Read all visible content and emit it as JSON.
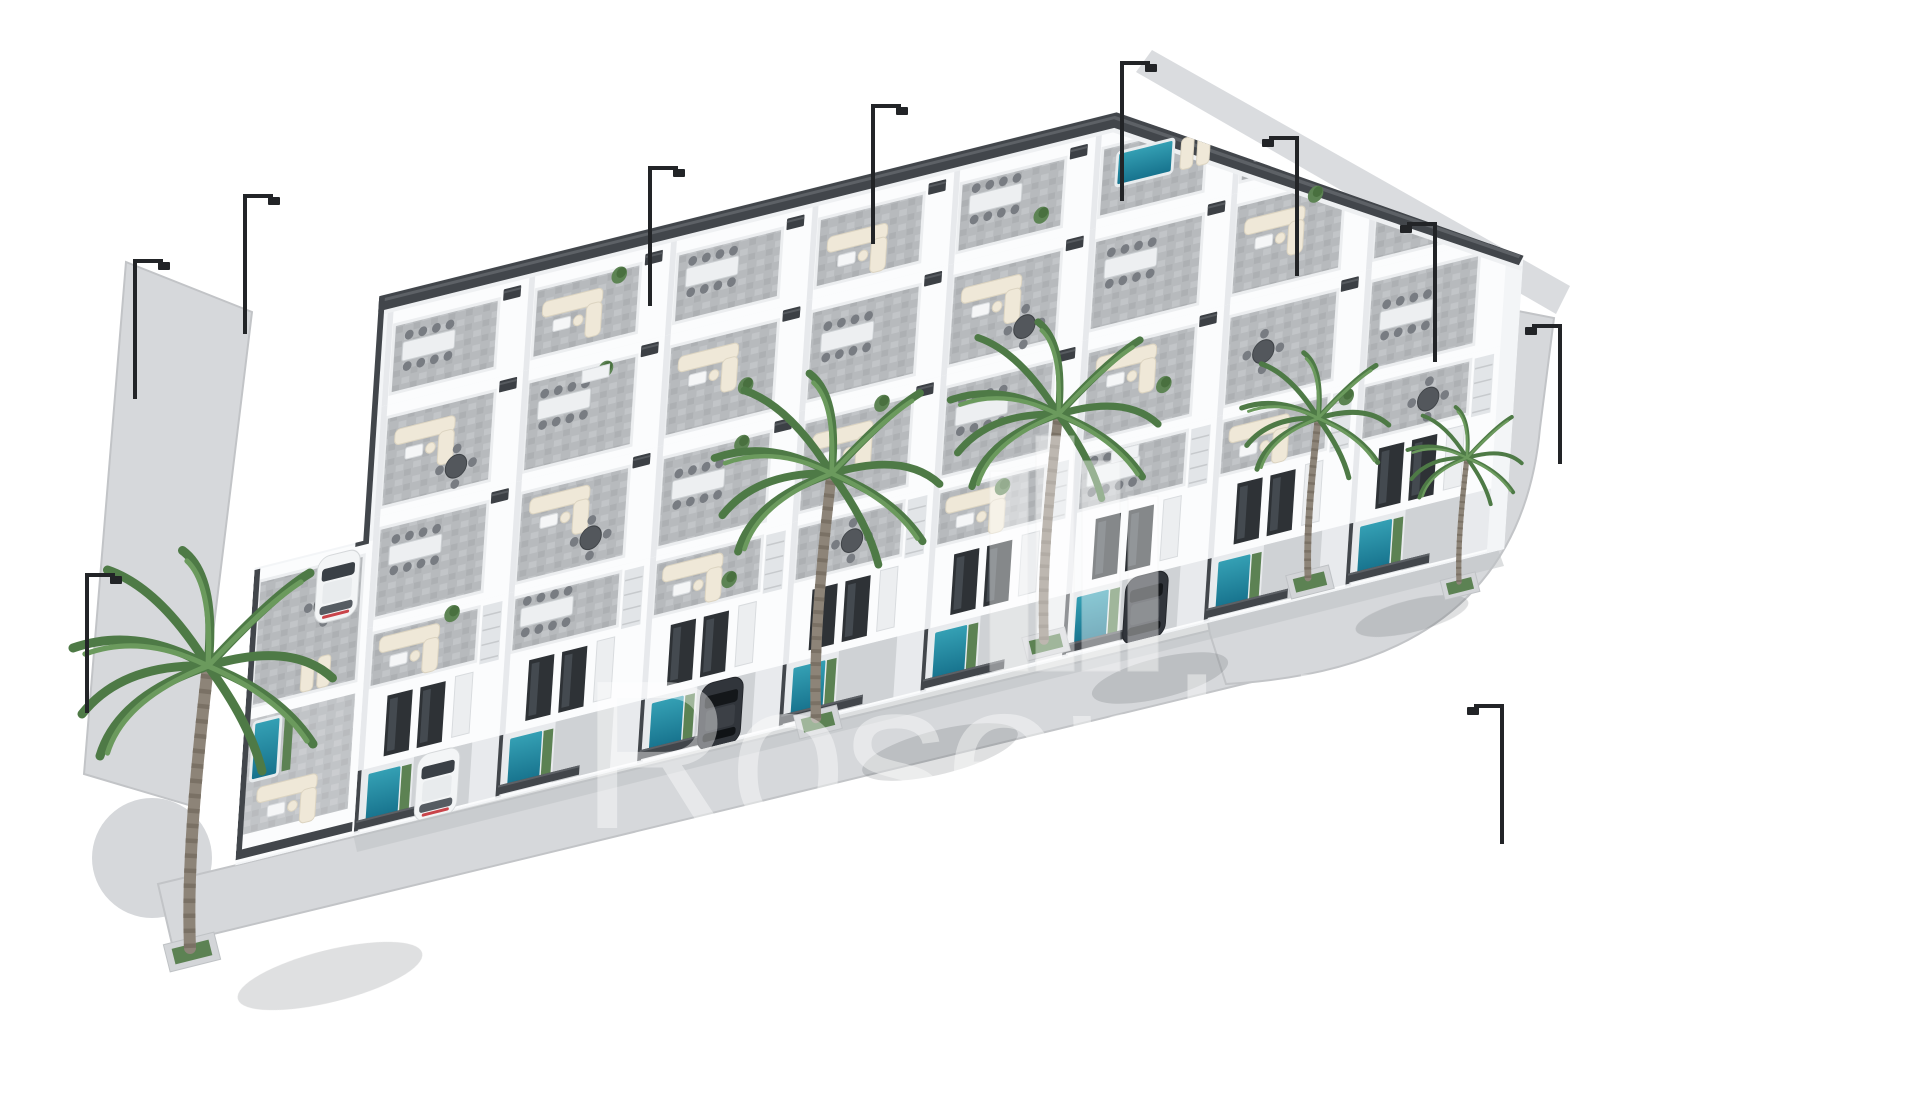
{
  "scene": {
    "type": "3d-architectural-render",
    "description": "Aerial 3D render of a modern white residential development: four rows of two-storey townhouse villas with grey-tiled roof terraces furnished with cream sofas and dining sets, private turquoise plunge pools and driveways behind dark slatted fences, palm trees in pavement planters, black street lamps and a curved grey sidewalk wrapping the block, all on a plain white background.",
    "watermark": {
      "text": "Rosenhill",
      "logo": "building-bars-logo",
      "opacity": 0.42
    },
    "elements": {
      "villa_rows": 4,
      "villas_visible_approx": 24,
      "pools_visible": 10,
      "palm_trees": 5,
      "street_lamps": 10,
      "planters": 5,
      "cars": [
        {
          "color": "white",
          "type": "suv"
        },
        {
          "color": "white",
          "type": "hatchback"
        },
        {
          "color": "dark-grey",
          "type": "car"
        },
        {
          "color": "dark-grey",
          "type": "car"
        }
      ]
    },
    "colors": {
      "background": "#ffffff",
      "wall_white": "#fbfcfd",
      "wall_shade": "#e7e9ec",
      "terrace_tile": "#b7babd",
      "paving_light": "#cfd2d5",
      "pavement": "#d6d8db",
      "pavement_edge": "#c2c4c7",
      "fence_dark": "#42464b",
      "pool_teal": "#2b8fa6",
      "pool_deep": "#16718c",
      "greenery": "#5c8253",
      "palm_green": "#4e7a46",
      "cream_furniture": "#efe8d8",
      "car_dark": "#31353b",
      "lamp_black": "#222427",
      "shadow": "#383c40",
      "watermark_white": "#ffffff"
    }
  }
}
